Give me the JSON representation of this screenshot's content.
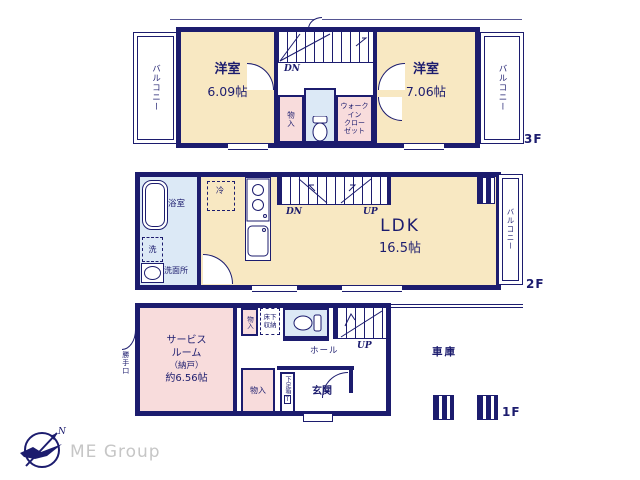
{
  "colors": {
    "wall": "#1c1c6e",
    "room": "#f8e8c2",
    "closet_pink": "#f8dcdc",
    "wet_blue": "#dce9f6",
    "logo_text": "#c6c6c6"
  },
  "f3": {
    "floor_label": "3F",
    "balcony_left": "バルコニー",
    "balcony_right": "バルコニー",
    "room_left": {
      "name": "洋室",
      "size": "6.09帖"
    },
    "room_right": {
      "name": "洋室",
      "size": "7.06帖"
    },
    "stairs_dn": "DN",
    "closet": "物入",
    "wic_lines": [
      "ウォーク",
      "イン",
      "クロー",
      "ゼット"
    ]
  },
  "f2": {
    "floor_label": "2F",
    "bath": "浴室",
    "laundry": "洗",
    "washroom": "洗面所",
    "fridge": "冷",
    "stairs_dn": "DN",
    "stairs_up": "UP",
    "ldk": {
      "name": "LDK",
      "size": "16.5帖"
    },
    "balcony": "バルコニー"
  },
  "f1": {
    "floor_label": "1F",
    "service_room_lines": [
      "サービス",
      "ルーム",
      "（納戸）",
      "約6.56帖"
    ],
    "back_door": "勝手口",
    "closet_top": "物入",
    "underfloor_lines": [
      "床下",
      "収納"
    ],
    "hall": "ホール",
    "stairs_up": "UP",
    "entrance": "玄関",
    "shoe_box": "下足箱",
    "shoe_box_tag": "T",
    "closet_bottom": "物入",
    "garage": "車庫"
  },
  "footer": {
    "brand": "ME Group",
    "compass_north": "N"
  }
}
